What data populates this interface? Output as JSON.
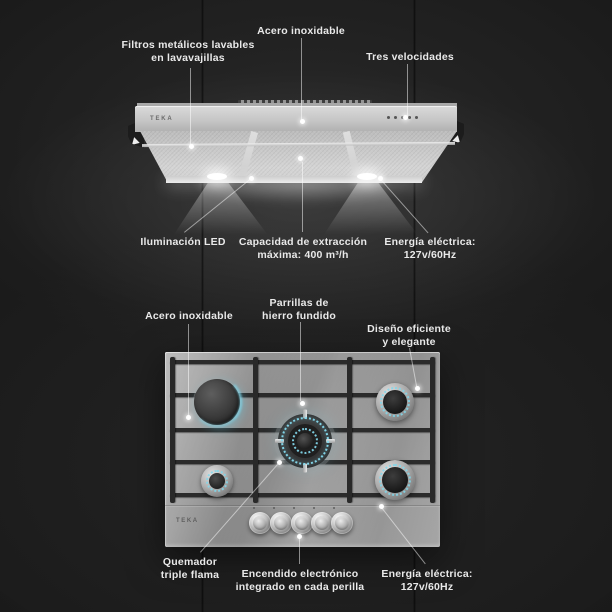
{
  "product": {
    "brand": "TEKA",
    "hood": {
      "logo": "TEKA",
      "callouts": [
        {
          "name": "filters",
          "text": "Filtros metálicos lavables\nen lavavajillas"
        },
        {
          "name": "stainless",
          "text": "Acero inoxidable"
        },
        {
          "name": "speeds",
          "text": "Tres velocidades"
        },
        {
          "name": "led",
          "text": "Iluminación LED"
        },
        {
          "name": "capacity",
          "text": "Capacidad de extracción\nmáxima: 400 m³/h"
        },
        {
          "name": "power",
          "text": "Energía eléctrica:\n127v/60Hz"
        }
      ]
    },
    "cooktop": {
      "logo": "TEKA",
      "burner_count": 5,
      "knob_count": 5,
      "callouts": [
        {
          "name": "stainless",
          "text": "Acero inoxidable"
        },
        {
          "name": "grates",
          "text": "Parrillas de\nhierro fundido"
        },
        {
          "name": "design",
          "text": "Diseño eficiente\ny elegante"
        },
        {
          "name": "triple-burner",
          "text": "Quemador\ntriple flama"
        },
        {
          "name": "ignition",
          "text": "Encendido electrónico\nintegrado en cada perilla"
        },
        {
          "name": "power",
          "text": "Energía eléctrica:\n127v/60Hz"
        }
      ]
    },
    "colors": {
      "background": "#1b1b1b",
      "label_text": "#e9e9e9",
      "flame_accent": "#7fd8ec",
      "steel": "#a8a8a8"
    }
  }
}
